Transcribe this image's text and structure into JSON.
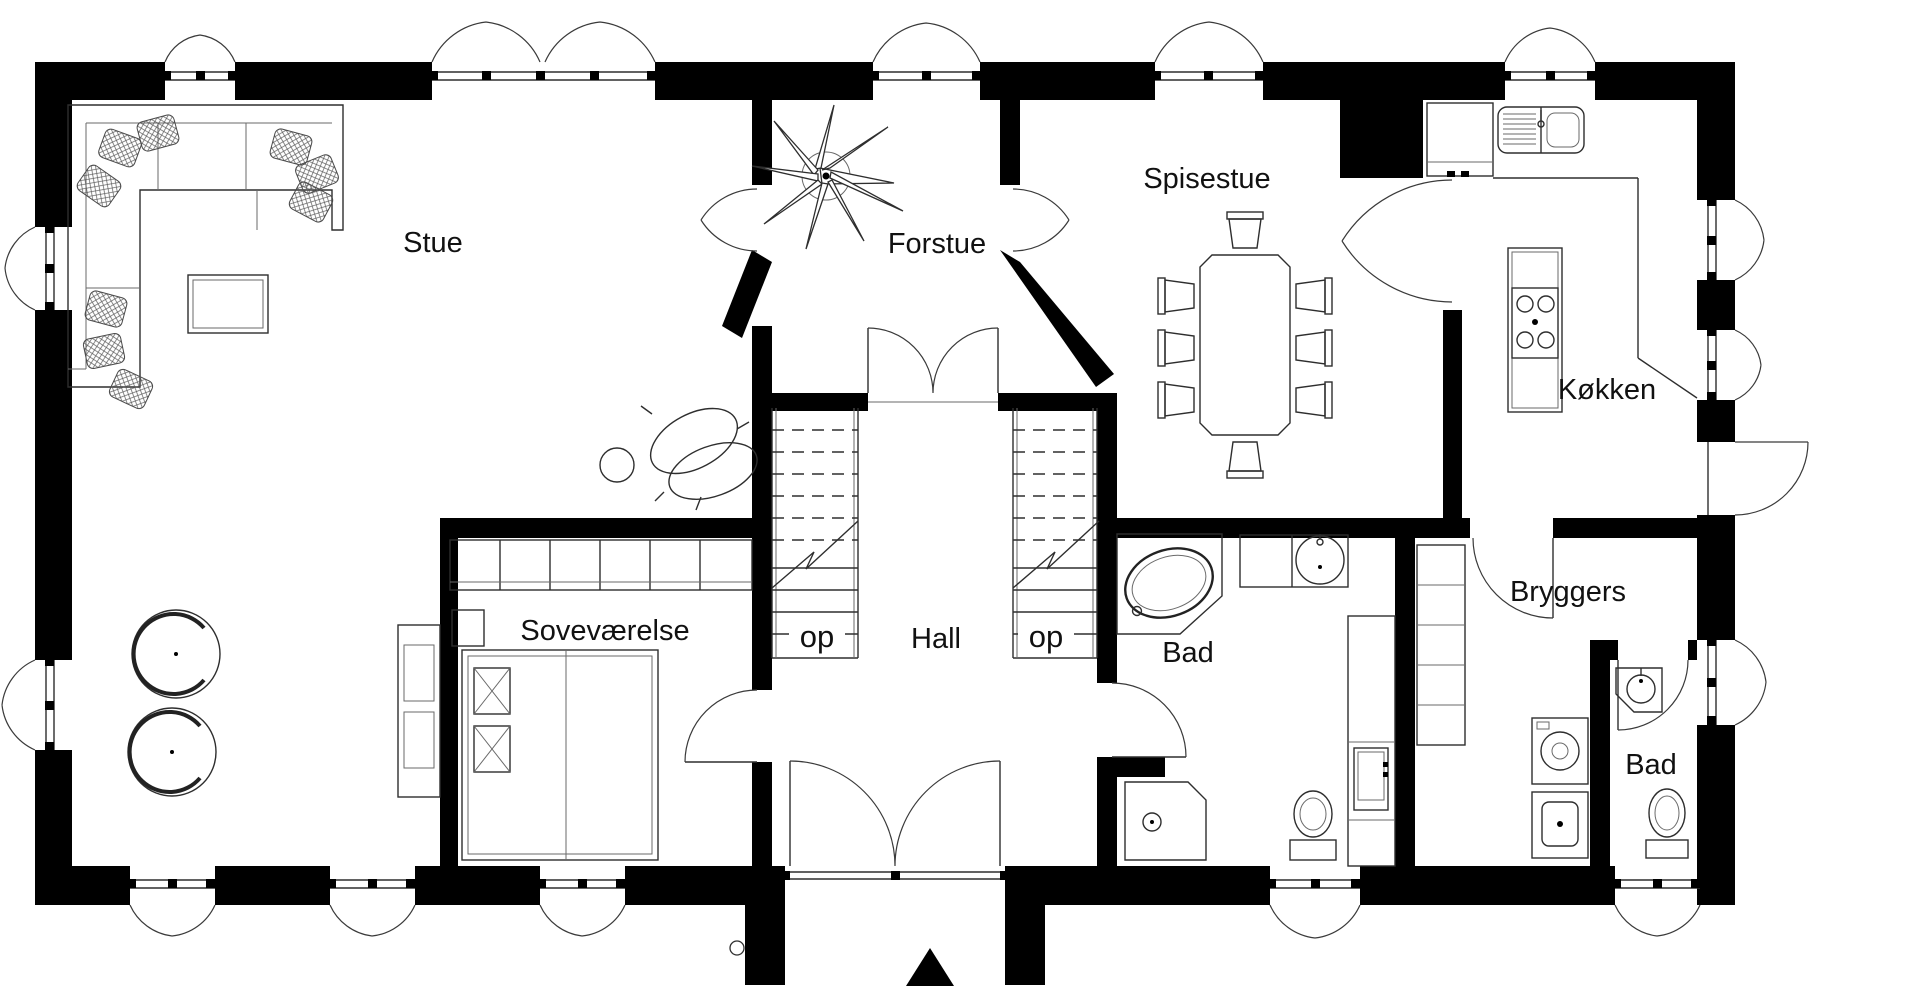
{
  "floorplan": {
    "title": "",
    "rooms": [
      {
        "id": "stue",
        "label": "Stue"
      },
      {
        "id": "forstue",
        "label": "Forstue"
      },
      {
        "id": "spisestue",
        "label": "Spisestue"
      },
      {
        "id": "kokken",
        "label": "Køkken"
      },
      {
        "id": "sovevaerelse",
        "label": "Soveværelse"
      },
      {
        "id": "hall",
        "label": "Hall"
      },
      {
        "id": "bad_center",
        "label": "Bad"
      },
      {
        "id": "bryggers",
        "label": "Bryggers"
      },
      {
        "id": "bad_right",
        "label": "Bad"
      }
    ],
    "stairs": {
      "up_label": "op"
    },
    "colors": {
      "wall": "#000000",
      "line": "#2e2e2e",
      "text": "#111111",
      "background": "#ffffff"
    }
  }
}
